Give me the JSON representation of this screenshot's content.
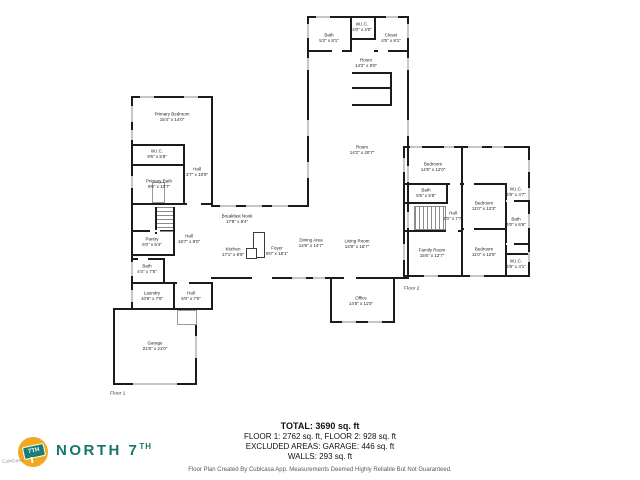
{
  "branding": {
    "wordmark": "NORTH 7",
    "wordmark_suffix": "TH",
    "sign_text": "7TH",
    "watermark": "CubiCasa",
    "accent_teal": "#15766C",
    "accent_yellow": "#F2A71E"
  },
  "floor_labels": {
    "floor1": "Floor 1",
    "floor2": "Floor 2"
  },
  "summary": {
    "total": "TOTAL: 3690 sq. ft",
    "floors": "FLOOR 1: 2762 sq. ft, FLOOR 2: 928 sq. ft",
    "excluded": "EXCLUDED AREAS: GARAGE: 446 sq. ft",
    "walls": "WALLS: 293 sq. ft",
    "disclaimer": "Floor Plan Created By Cubicasa App. Measurements Deemed Highly Reliable But Not Guaranteed."
  },
  "rooms": [
    {
      "name": "Primary Bedroom",
      "dims": "15'4\" x 14'0\""
    },
    {
      "name": "W.I.C.",
      "dims": "9'6\" x 5'8\""
    },
    {
      "name": "Primary Bath",
      "dims": "9'6\" x 10'7\""
    },
    {
      "name": "Hall",
      "dims": "3'7\" x 10'9\""
    },
    {
      "name": "Pantry",
      "dims": "6'0\" x 5'4\""
    },
    {
      "name": "Hall",
      "dims": "16'7\" x 8'0\""
    },
    {
      "name": "Bath",
      "dims": "4'4\" x 7'6\""
    },
    {
      "name": "Laundry",
      "dims": "10'6\" x 7'6\""
    },
    {
      "name": "Hall",
      "dims": "5'0\" x 7'0\""
    },
    {
      "name": "Garage",
      "dims": "21'8\" x 21'0\""
    },
    {
      "name": "Breakfast Nook",
      "dims": "17'8\" x 8'4\""
    },
    {
      "name": "Kitchen",
      "dims": "17'1\" x 8'9\""
    },
    {
      "name": "Foyer",
      "dims": "8'0\" x 18'1\""
    },
    {
      "name": "Dining Area",
      "dims": "14'8\" x 14'7\""
    },
    {
      "name": "Living Room",
      "dims": "14'8\" x 16'7\""
    },
    {
      "name": "Office",
      "dims": "14'6\" x 11'0\""
    },
    {
      "name": "Bath",
      "dims": "5'2\" x 8'1\""
    },
    {
      "name": "W.I.C.",
      "dims": "4'0\" x 4'0\""
    },
    {
      "name": "Closet",
      "dims": "4'6\" x 8'1\""
    },
    {
      "name": "Room",
      "dims": "14'2\" x 9'0\""
    },
    {
      "name": "Room",
      "dims": "14'2\" x 20'7\""
    },
    {
      "name": "Bedroom",
      "dims": "14'8\" x 12'0\""
    },
    {
      "name": "Bath",
      "dims": "5'5\" x 5'8\""
    },
    {
      "name": "Hall",
      "dims": "4'0\" x 7'7\""
    },
    {
      "name": "Bedroom",
      "dims": "11'0\" x 12'3\""
    },
    {
      "name": "W.I.C.",
      "dims": "4'8\" x 4'7\""
    },
    {
      "name": "Bath",
      "dims": "4'0\" x 6'6\""
    },
    {
      "name": "Family Room",
      "dims": "15'6\" x 12'7\""
    },
    {
      "name": "Bedroom",
      "dims": "11'0\" x 12'5\""
    },
    {
      "name": "W.I.C.",
      "dims": "4'8\" x 4'1\""
    }
  ]
}
